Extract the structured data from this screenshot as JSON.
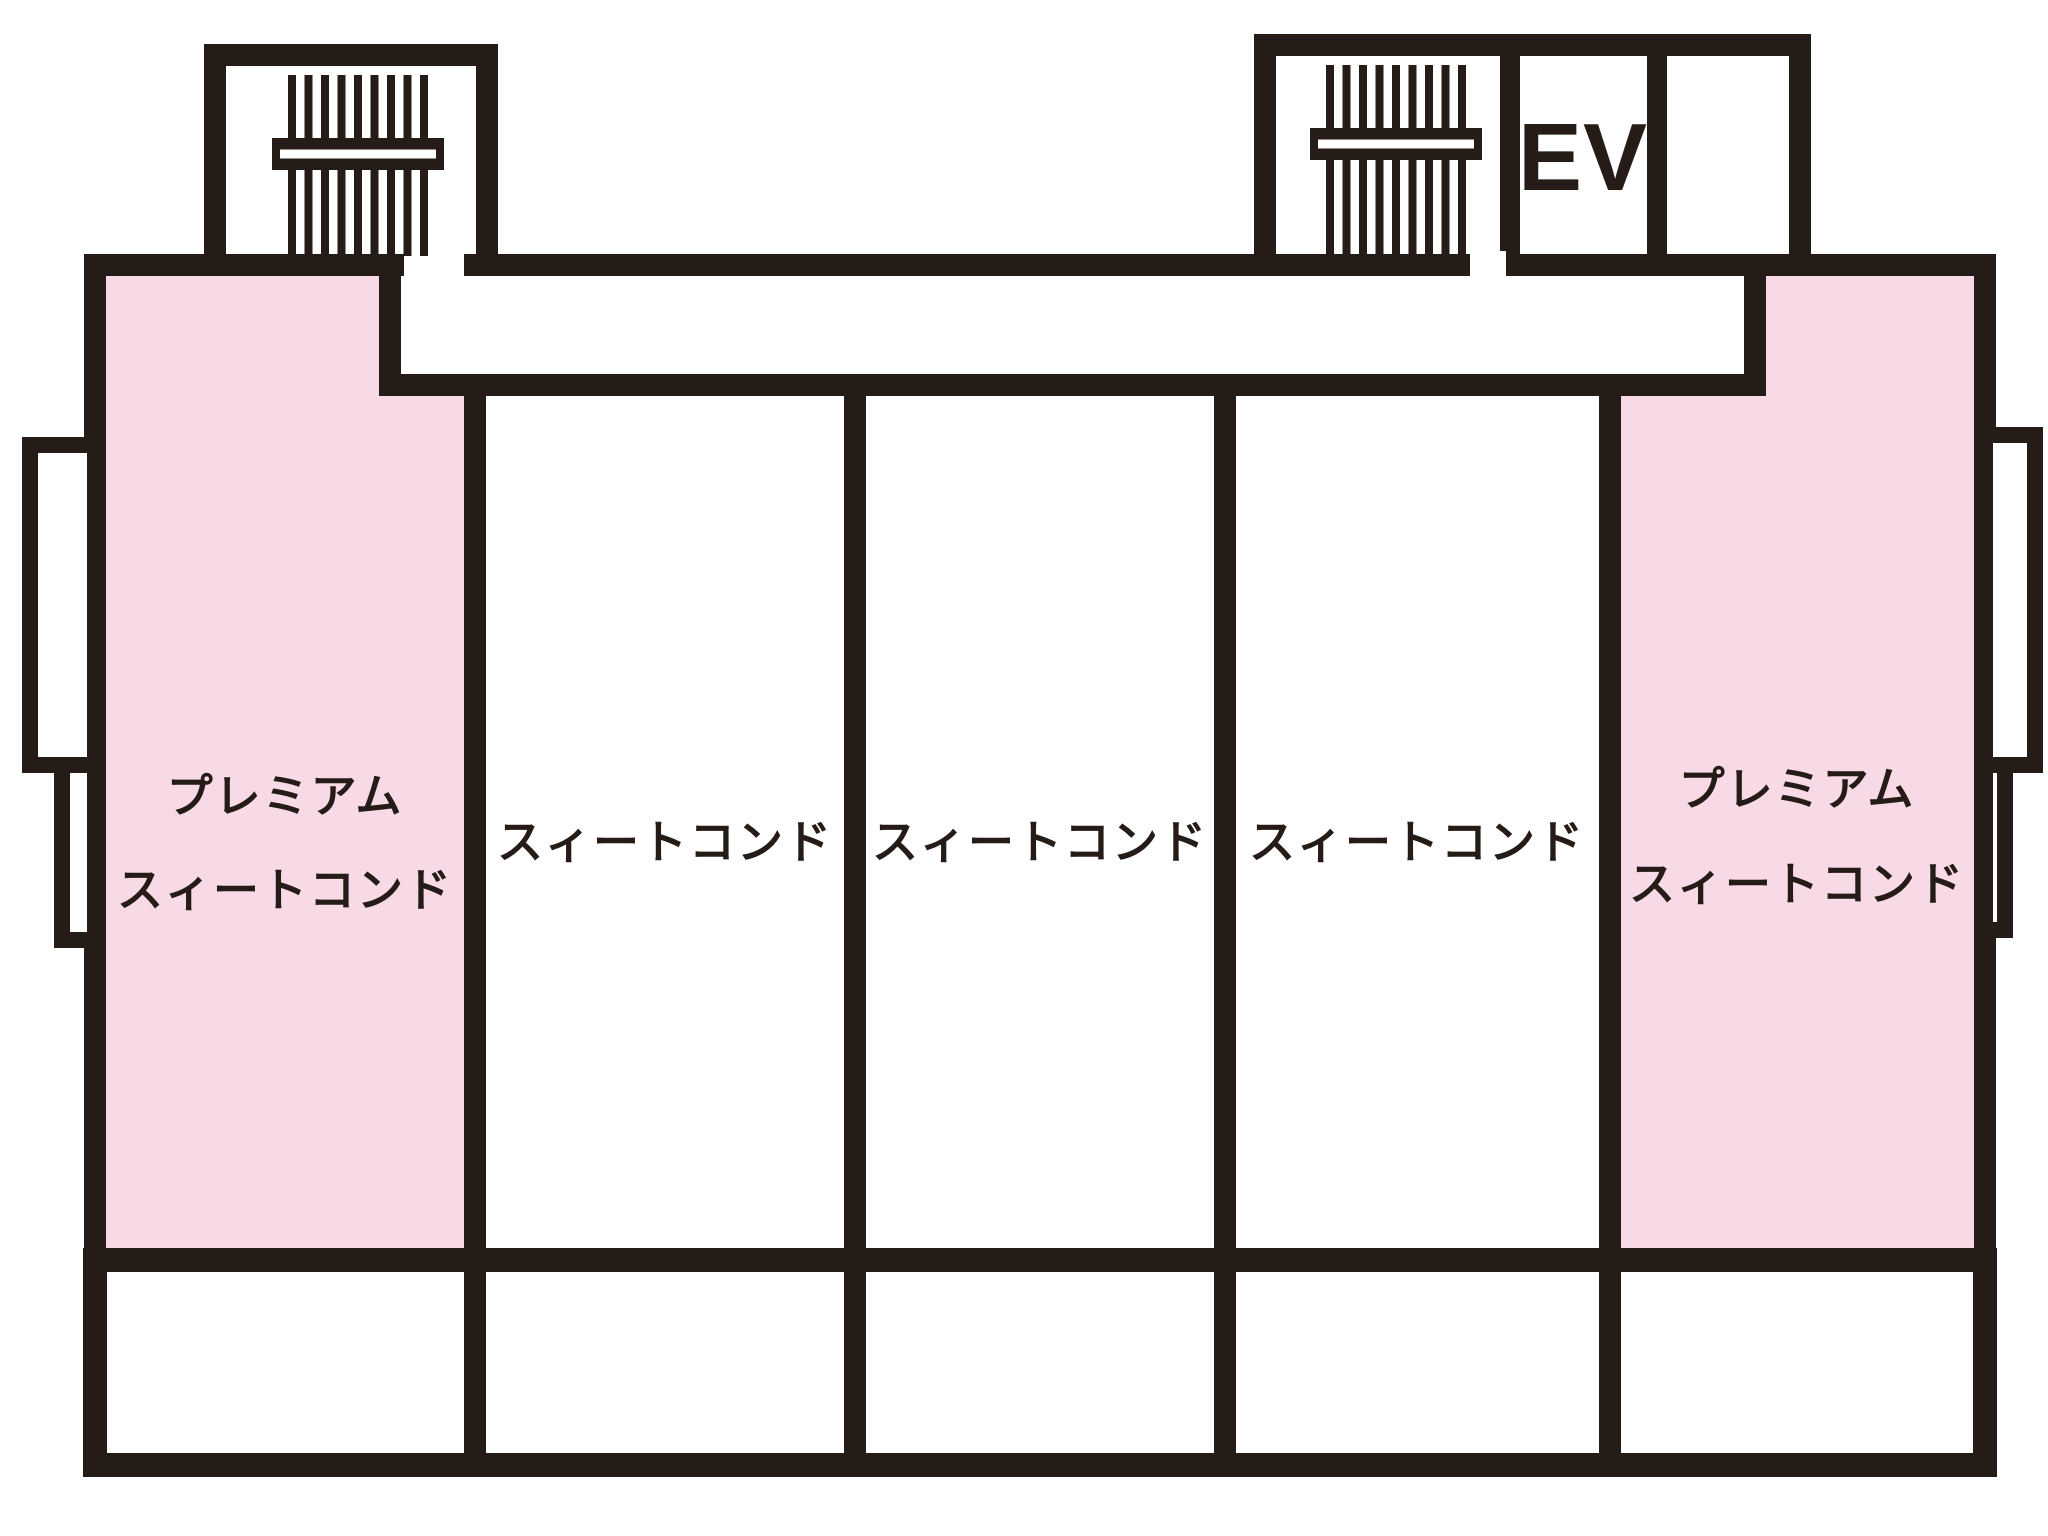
{
  "colors": {
    "wall": "#251b17",
    "premium": "#f8d9e6",
    "bg": "#ffffff"
  },
  "rooms": [
    {
      "type": "premium",
      "label_line1": "プレミアム",
      "label_line2": "スィートコンド"
    },
    {
      "type": "suite",
      "label": "スィートコンド"
    },
    {
      "type": "suite",
      "label": "スィートコンド"
    },
    {
      "type": "suite",
      "label": "スィートコンド"
    },
    {
      "type": "premium",
      "label_line1": "プレミアム",
      "label_line2": "スィートコンド"
    }
  ],
  "elevator": {
    "label": "EV"
  },
  "icons": {
    "stairs_west": "stairs",
    "stairs_east": "stairs"
  }
}
